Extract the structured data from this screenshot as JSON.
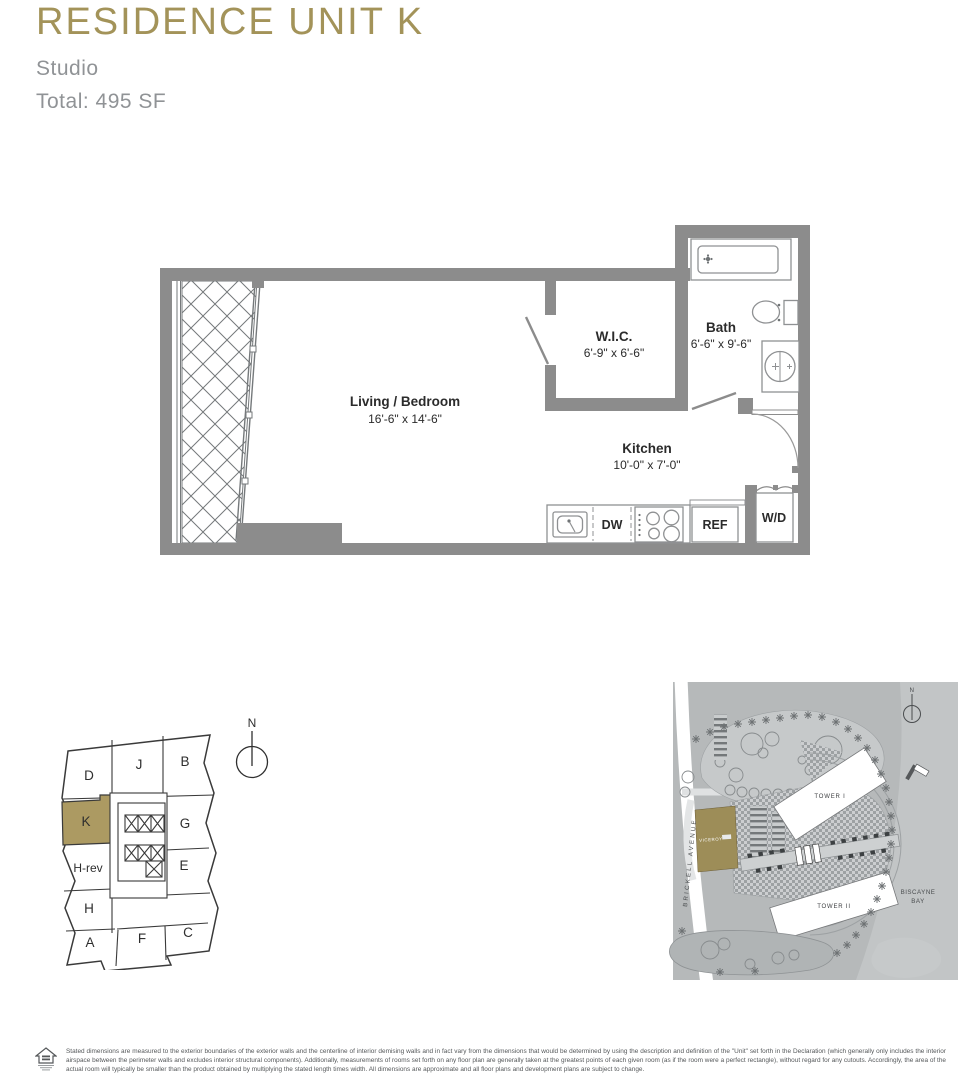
{
  "header": {
    "title": "RESIDENCE UNIT K",
    "unit_type": "Studio",
    "total_area": "Total: 495 SF"
  },
  "colors": {
    "accent_gold": "#a39359",
    "keyplan_gold": "#ac9a62",
    "wall_gray": "#8c8c8c",
    "subtitle_gray": "#909396",
    "site_background": "#b6b9ba"
  },
  "floor_plan": {
    "rooms": [
      {
        "name": "Living / Bedroom",
        "dimensions": "16'-6\" x 14'-6\""
      },
      {
        "name": "W.I.C.",
        "dimensions": "6'-9\" x 6'-6\""
      },
      {
        "name": "Bath",
        "dimensions": "6'-6\" x 9'-6\""
      },
      {
        "name": "Kitchen",
        "dimensions": "10'-0\" x 7'-0\""
      }
    ],
    "appliances": [
      {
        "label": "DW"
      },
      {
        "label": "REF"
      },
      {
        "label": "W/D"
      }
    ]
  },
  "keyplan": {
    "north_label": "N",
    "units": [
      {
        "label": "D"
      },
      {
        "label": "J"
      },
      {
        "label": "B"
      },
      {
        "label": "K",
        "highlighted": true
      },
      {
        "label": "H-rev"
      },
      {
        "label": "G"
      },
      {
        "label": "E"
      },
      {
        "label": "H"
      },
      {
        "label": "A"
      },
      {
        "label": "F"
      },
      {
        "label": "C"
      }
    ]
  },
  "site_plan": {
    "labels": {
      "tower1": "TOWER I",
      "tower2": "TOWER II",
      "building": "VICEROY",
      "bay_line1": "BISCAYNE",
      "bay_line2": "BAY",
      "street": "BRICKELL AVENUE",
      "north": "N"
    }
  },
  "footer": {
    "disclaimer": "Stated dimensions are measured to the exterior boundaries of the exterior walls and the centerline of interior demising walls and in fact vary from the dimensions that would be determined by using the description and definition of the \"Unit\" set forth in the Declaration (which generally only includes the interior airspace between the perimeter walls and excludes interior structural components). Additionally, measurements of rooms set forth on any floor plan are generally taken at the greatest points of each given room (as if the room were a perfect rectangle), without regard for any cutouts. Accordingly, the area of the actual room will typically be smaller than the product obtained by multiplying the stated length times width. All dimensions are approximate and all floor plans and development plans are subject to change."
  }
}
